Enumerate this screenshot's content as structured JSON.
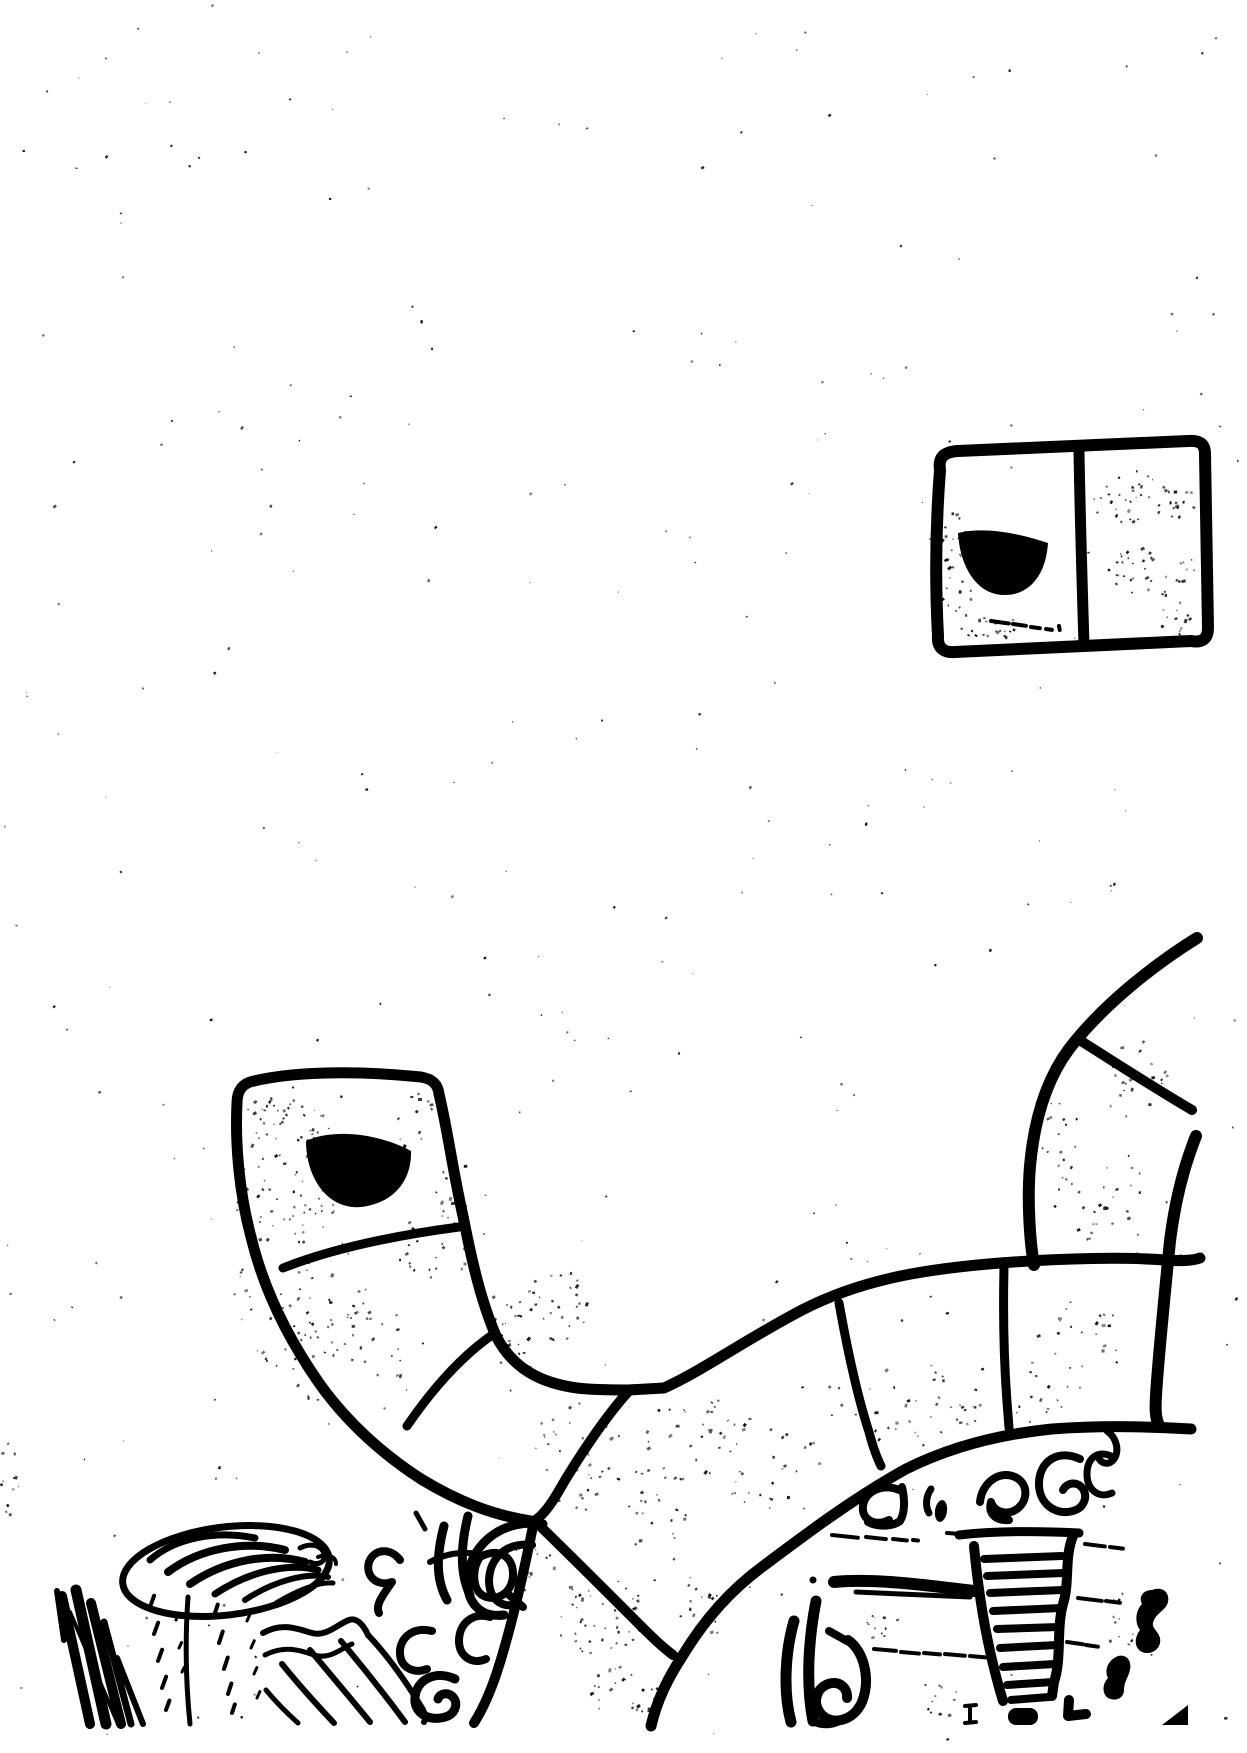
{
  "meta": {
    "kind": "scanned ink sketch, black on white, no visible text"
  },
  "colors": {
    "ink": "#000000",
    "paper": "#ffffff"
  },
  "window_sketch": {
    "name": "two-pane window with dark half-disc in left pane",
    "underline_dashes": [
      [
        991,
        621,
        18,
        8
      ],
      [
        1013,
        624,
        13,
        8
      ],
      [
        1031,
        627,
        9,
        8
      ],
      [
        1046,
        629,
        6,
        8
      ],
      [
        1059,
        626,
        4,
        80
      ]
    ]
  },
  "arm_sketch": {
    "name": "segmented curved arm with rounded cap and dark half-disc",
    "segments": 3
  },
  "rim_sketch": {
    "name": "large segmented wheel rim arc",
    "radial_dividers": 5
  },
  "band_sketch": {
    "name": "upper-right segmented band merging into rim",
    "radial_dividers": 1
  },
  "interior": {
    "tower": {
      "name": "tapered ladder-tower scribble",
      "rungs": [
        [
          984,
          1559,
          1062,
          1556
        ],
        [
          987,
          1576,
          1064,
          1573
        ],
        [
          990,
          1593,
          1063,
          1590
        ],
        [
          993,
          1611,
          1061,
          1608
        ],
        [
          997,
          1629,
          1059,
          1627
        ],
        [
          1000,
          1648,
          1057,
          1645
        ],
        [
          1003,
          1667,
          1055,
          1664
        ],
        [
          1007,
          1685,
          1053,
          1682
        ],
        [
          1011,
          1700,
          1049,
          1697
        ]
      ]
    },
    "dash_rows": [
      {
        "w": 4,
        "d": [
          [
            832,
            1535,
            26,
            6
          ],
          [
            866,
            1537,
            20,
            6
          ],
          [
            893,
            1539,
            14,
            6
          ],
          [
            913,
            1540,
            5,
            6
          ],
          [
            947,
            1533,
            14,
            4
          ]
        ]
      },
      {
        "w": 4,
        "d": [
          [
            1085,
            1544,
            20,
            7
          ],
          [
            1110,
            1547,
            13,
            7
          ]
        ]
      },
      {
        "w": 4,
        "d": [
          [
            874,
            1649,
            22,
            5
          ],
          [
            901,
            1652,
            18,
            5
          ],
          [
            924,
            1653,
            16,
            5
          ],
          [
            945,
            1654,
            20,
            5
          ],
          [
            970,
            1656,
            24,
            5
          ]
        ]
      },
      {
        "w": 4,
        "d": [
          [
            1078,
            1598,
            24,
            7
          ],
          [
            1106,
            1601,
            14,
            7
          ]
        ]
      },
      {
        "w": 4,
        "d": [
          [
            1067,
            1642,
            16,
            8
          ],
          [
            1086,
            1645,
            12,
            8
          ]
        ]
      }
    ]
  },
  "ground": {
    "plate": {
      "name": "tilted oval plate with nested shell arcs on a stem"
    },
    "sticks": {
      "name": "cluster of leaning stick strokes"
    },
    "ramp": {
      "name": "striped ramp / stair scribble"
    },
    "trails": [
      {
        "w": 4,
        "d": [
          [
            150,
            1607,
            12,
            -70
          ],
          [
            154,
            1634,
            12,
            -70
          ],
          [
            158,
            1661,
            12,
            -70
          ],
          [
            162,
            1688,
            12,
            -70
          ],
          [
            166,
            1710,
            10,
            -70
          ]
        ]
      },
      {
        "w": 3,
        "d": [
          [
            176,
            1620,
            6,
            -65
          ],
          [
            179,
            1648,
            6,
            -65
          ],
          [
            182,
            1672,
            5,
            -65
          ]
        ]
      },
      {
        "w": 4,
        "d": [
          [
            214,
            1616,
            12,
            -72
          ],
          [
            219,
            1643,
            12,
            -72
          ],
          [
            224,
            1669,
            12,
            -72
          ],
          [
            228,
            1694,
            11,
            -72
          ],
          [
            232,
            1713,
            9,
            -72
          ]
        ]
      },
      {
        "w": 3,
        "d": [
          [
            247,
            1621,
            8,
            -66
          ],
          [
            251,
            1648,
            8,
            -66
          ],
          [
            254,
            1674,
            7,
            -66
          ],
          [
            257,
            1698,
            7,
            -66
          ]
        ]
      }
    ]
  },
  "speckle": {
    "global_count": 300,
    "clusters": [
      [
        285,
        1175,
        55,
        75,
        80
      ],
      [
        300,
        1290,
        70,
        80,
        60
      ],
      [
        350,
        1360,
        60,
        60,
        40
      ],
      [
        430,
        1250,
        40,
        40,
        20
      ],
      [
        520,
        1330,
        35,
        55,
        30
      ],
      [
        560,
        1300,
        30,
        40,
        20
      ],
      [
        600,
        1615,
        45,
        40,
        45
      ],
      [
        625,
        1690,
        35,
        25,
        25
      ],
      [
        575,
        1450,
        50,
        60,
        35
      ],
      [
        650,
        1500,
        40,
        50,
        25
      ],
      [
        700,
        1430,
        60,
        50,
        30
      ],
      [
        780,
        1470,
        60,
        45,
        25
      ],
      [
        900,
        1400,
        80,
        40,
        30
      ],
      [
        1000,
        1390,
        70,
        40,
        25
      ],
      [
        1080,
        1350,
        50,
        50,
        25
      ],
      [
        1100,
        1190,
        50,
        50,
        30
      ],
      [
        1135,
        1080,
        35,
        45,
        20
      ],
      [
        1060,
        1130,
        30,
        40,
        15
      ],
      [
        958,
        565,
        30,
        55,
        35
      ],
      [
        990,
        625,
        45,
        12,
        20
      ],
      [
        1145,
        498,
        52,
        32,
        45
      ],
      [
        1152,
        572,
        48,
        28,
        35
      ],
      [
        1185,
        620,
        30,
        20,
        15
      ],
      [
        290,
        1115,
        45,
        25,
        25
      ],
      [
        420,
        1120,
        30,
        30,
        12
      ],
      [
        460,
        1190,
        25,
        35,
        12
      ],
      [
        530,
        1560,
        25,
        30,
        18
      ],
      [
        705,
        1605,
        25,
        40,
        15
      ],
      [
        880,
        1625,
        20,
        20,
        12
      ],
      [
        940,
        1700,
        25,
        20,
        12
      ],
      [
        1120,
        1620,
        20,
        30,
        10
      ],
      [
        8,
        1480,
        10,
        45,
        12
      ]
    ]
  }
}
